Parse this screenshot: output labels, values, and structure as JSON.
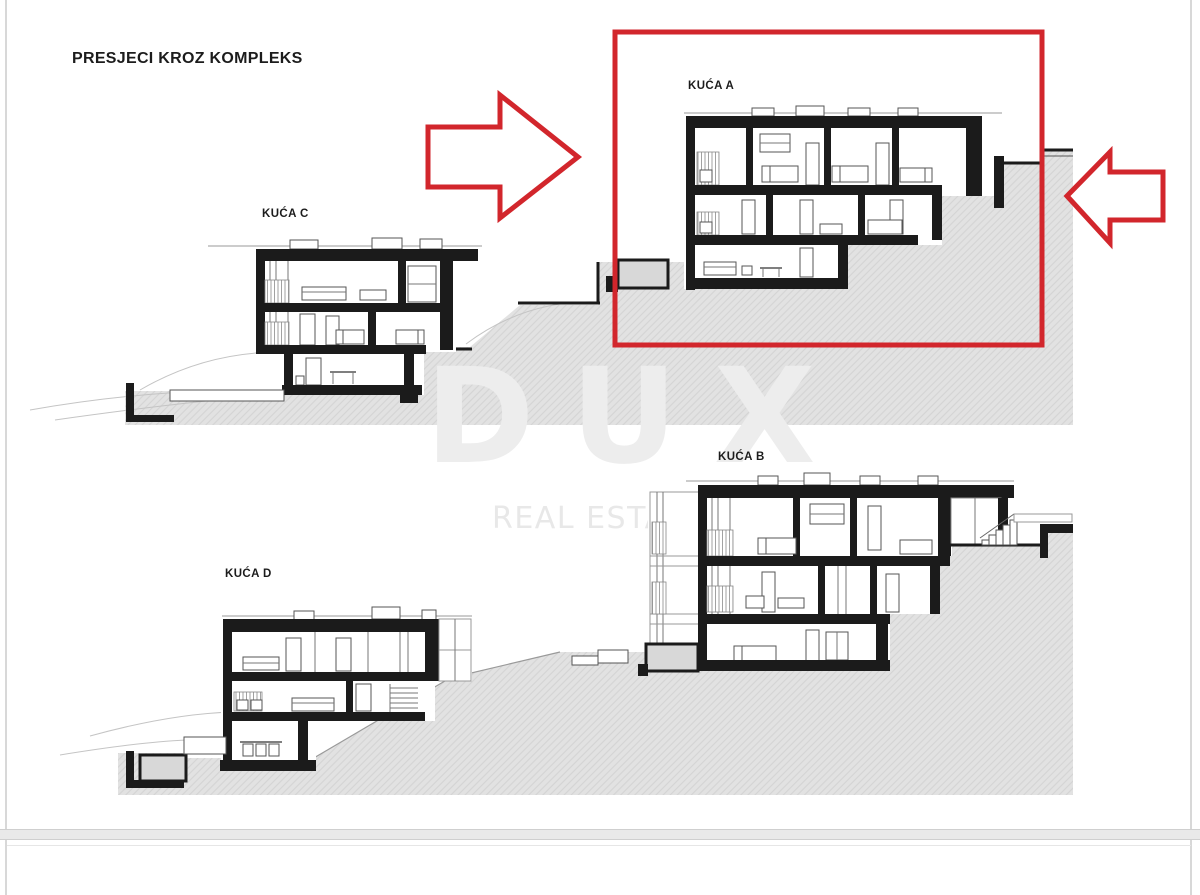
{
  "title": "PRESJECI KROZ KOMPLEKS",
  "houses": {
    "a": {
      "label": "KUĆA A",
      "highlighted": true
    },
    "b": {
      "label": "KUĆA B"
    },
    "c": {
      "label": "KUĆA C"
    },
    "d": {
      "label": "KUĆA D"
    }
  },
  "watermark": {
    "line1": "DUX",
    "line2": "REAL ESTATE"
  },
  "colors": {
    "accent_red": "#d2262c",
    "terrain_gray": "#e2e2e2",
    "hatch_line": "#d4d4d4",
    "drawing_black": "#1b1b1b"
  }
}
